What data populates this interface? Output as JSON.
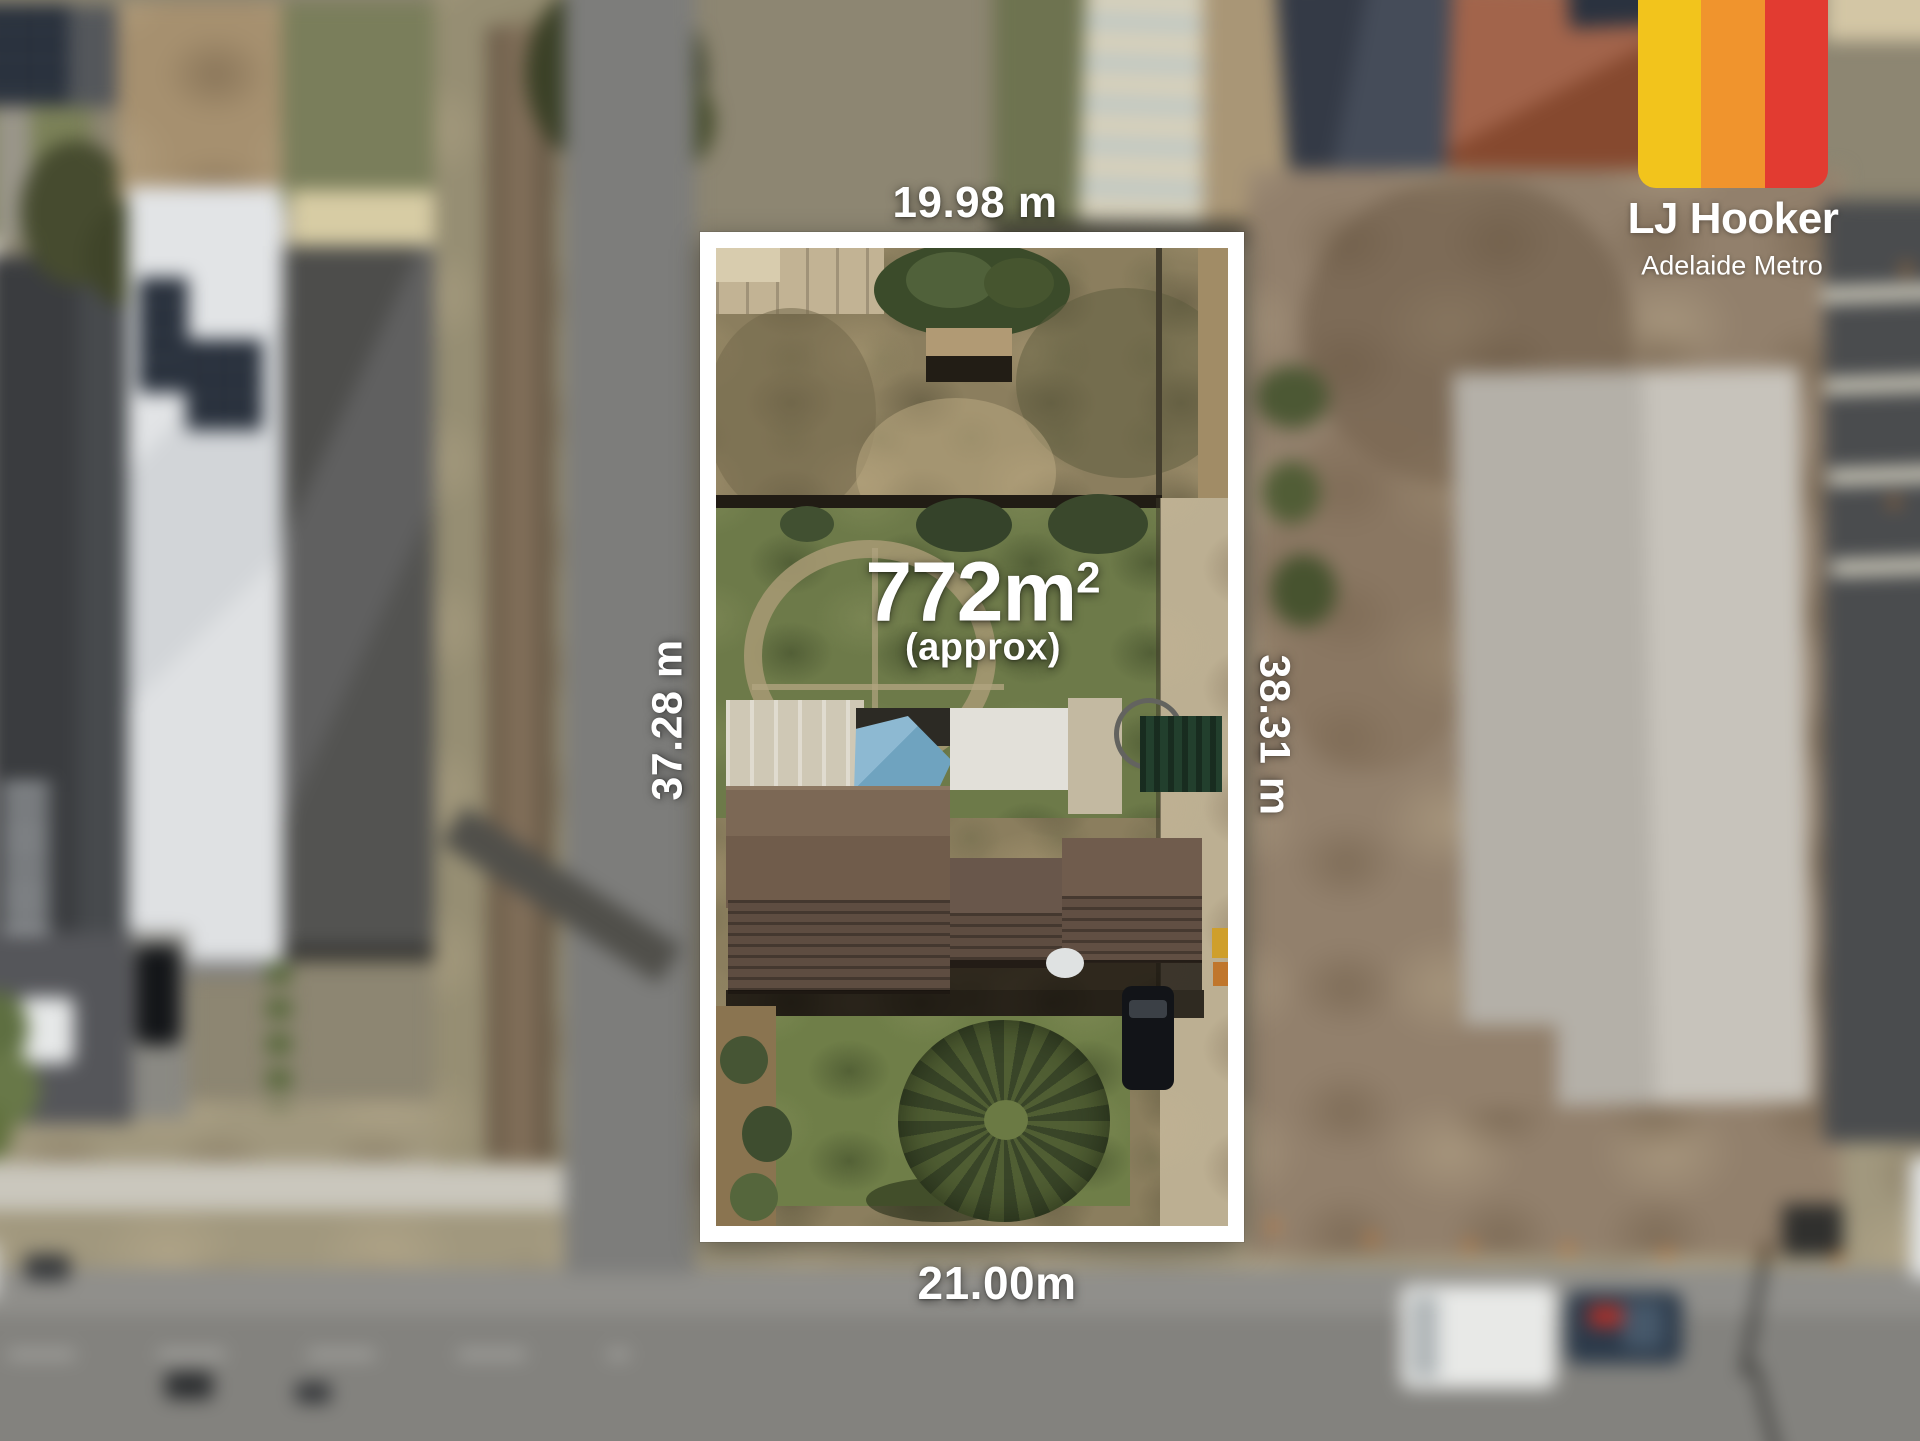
{
  "brand": {
    "name": "LJ Hooker",
    "region": "Adelaide Metro",
    "stripe_colors": [
      "#F2C41C",
      "#F0942D",
      "#E23B31"
    ]
  },
  "lot": {
    "area_value": "772m",
    "area_superscript": "2",
    "area_qualifier": "(approx)",
    "dimensions": {
      "top": "19.98 m",
      "left": "37.28 m",
      "right": "38.31 m",
      "bottom": "21.00m"
    },
    "boundary_color": "#FFFFFF"
  }
}
